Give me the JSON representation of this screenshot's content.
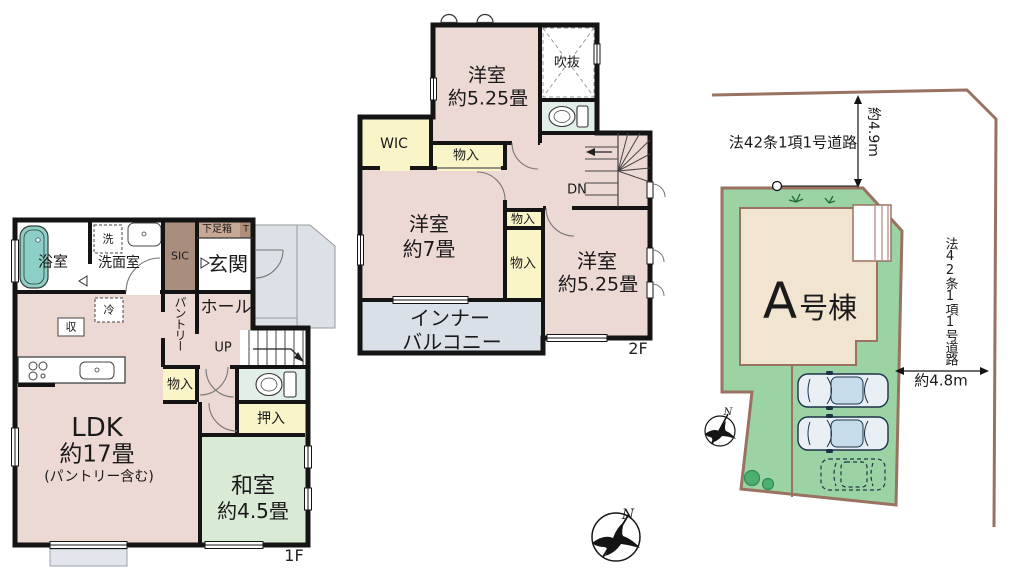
{
  "floor1": {
    "label": "1F",
    "bath": "浴室",
    "washroom": "洗面室",
    "washer": "洗",
    "sic": "SIC",
    "shoebox": "下足箱",
    "t_box": "T",
    "entrance": "玄関",
    "pantry": "パントリー",
    "hall": "ホール",
    "up": "UP",
    "fridge": "冷",
    "storage": "収",
    "monoire": "物入",
    "oshiire": "押入",
    "ldk_line1": "LDK",
    "ldk_line2": "約17畳",
    "ldk_line3": "(パントリー含む)",
    "washitsu_line1": "和室",
    "washitsu_line2": "約4.5畳"
  },
  "floor2": {
    "label": "2F",
    "room_top_line1": "洋室",
    "room_top_line2": "約5.25畳",
    "void": "吹抜",
    "wic": "WIC",
    "monoire_top": "物入",
    "monoire_mid": "物入",
    "monoire_low": "物入",
    "dn": "DN",
    "room_mid_line1": "洋室",
    "room_mid_line2": "約7畳",
    "room_right_line1": "洋室",
    "room_right_line2": "約5.25畳",
    "balcony_line1": "インナー",
    "balcony_line2": "バルコニー"
  },
  "site": {
    "building_a": "A",
    "building_suffix": "号棟",
    "road_top_label": "法42条1項1号道路",
    "road_right_label": "法42条1項1号道路",
    "dim_vertical": "約4.9m",
    "dim_horizontal": "約4.8m",
    "compass_site_n": "N",
    "compass_main_n": "N"
  },
  "colors": {
    "room_pink": "#EDD9D3",
    "tatami_green": "#D9EAD5",
    "closet_yellow": "#FAF4C9",
    "sic_brown": "#A98D7D",
    "shoebox_tan": "#C7A894",
    "balcony_gray": "#DAE0E8",
    "toilet_green": "#E2EFE8",
    "bathtub_teal": "#8BCFC7",
    "site_green": "#9CD3A5",
    "building_beige": "#F1E4D1",
    "boundary_brown": "#9A7262",
    "wall_black": "#141414",
    "car_body_blue": "#E8EFF5"
  }
}
